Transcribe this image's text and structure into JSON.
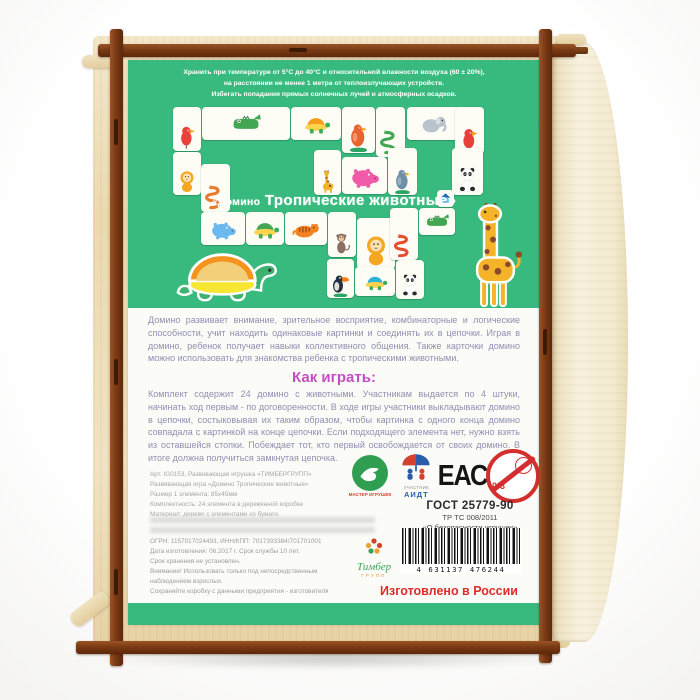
{
  "photo": {
    "description": "wooden box back with game label",
    "colors": {
      "label_green": "#38ba7e",
      "frame_brown": "#7b3a14",
      "plywood": "#ecd9ae",
      "heading_magenta": "#c44ec4",
      "body_text": "#8f8fb2",
      "made_in_red": "#e02b2b"
    }
  },
  "label": {
    "storage_note_lines": [
      "Хранить при температуре от 5°С до 40°С и относительной влажности воздуха (60 ± 20%),",
      "на расстоянии не менее 1 метра от теплоизлучающих устройств.",
      "Избегать попадания прямых солнечных лучей и атмосферных осадков."
    ],
    "title": {
      "prefix": "«Домино",
      "main": "Тропические животные»"
    },
    "chain_tiles": [
      {
        "kind": "parrot",
        "x": 45,
        "y": 47,
        "w": 28,
        "h": 44,
        "c": "#e8413c"
      },
      {
        "kind": "crocodile",
        "x": 74,
        "y": 47,
        "w": 88,
        "h": 33,
        "c": "#43a653"
      },
      {
        "kind": "turtle",
        "x": 163,
        "y": 47,
        "w": 50,
        "h": 33,
        "c": "#f49d1d"
      },
      {
        "kind": "bird",
        "x": 214,
        "y": 47,
        "w": 33,
        "h": 46,
        "c": "#e8632f",
        "mound": true
      },
      {
        "kind": "snake",
        "x": 248,
        "y": 47,
        "w": 29,
        "h": 50,
        "c": "#43a653"
      },
      {
        "kind": "elephant",
        "x": 279,
        "y": 47,
        "w": 53,
        "h": 33,
        "c": "#b9c3cb"
      },
      {
        "kind": "parrot",
        "x": 327,
        "y": 47,
        "w": 29,
        "h": 47,
        "c": "#e8413c"
      },
      {
        "kind": "lion",
        "x": 45,
        "y": 92,
        "w": 28,
        "h": 43,
        "c": "#f5a623"
      },
      {
        "kind": "snake",
        "x": 73,
        "y": 104,
        "w": 29,
        "h": 48,
        "c": "#e87a2e"
      },
      {
        "kind": "giraffe",
        "x": 186,
        "y": 90,
        "w": 27,
        "h": 45,
        "c": "#f0b429"
      },
      {
        "kind": "hippo",
        "x": 214,
        "y": 97,
        "w": 45,
        "h": 37,
        "c": "#ef5ba8"
      },
      {
        "kind": "bird",
        "x": 260,
        "y": 88,
        "w": 29,
        "h": 47,
        "c": "#6f8fa8",
        "mound": true
      },
      {
        "kind": "panda",
        "x": 324,
        "y": 88,
        "w": 31,
        "h": 47,
        "c": "#ffffff"
      },
      {
        "kind": "hippo",
        "x": 73,
        "y": 152,
        "w": 44,
        "h": 33,
        "c": "#6cb9f0"
      },
      {
        "kind": "turtle",
        "x": 118,
        "y": 152,
        "w": 38,
        "h": 33,
        "c": "#43a653"
      },
      {
        "kind": "tiger",
        "x": 157,
        "y": 152,
        "w": 42,
        "h": 33,
        "c": "#f58220"
      },
      {
        "kind": "monkey",
        "x": 200,
        "y": 152,
        "w": 28,
        "h": 45,
        "c": "#8d6e63"
      },
      {
        "kind": "lion",
        "x": 229,
        "y": 158,
        "w": 38,
        "h": 51,
        "c": "#f5a623"
      },
      {
        "kind": "snake",
        "x": 262,
        "y": 148,
        "w": 28,
        "h": 52,
        "c": "#e84b2e"
      },
      {
        "kind": "crocodile",
        "x": 291,
        "y": 148,
        "w": 36,
        "h": 27,
        "c": "#43a653"
      },
      {
        "kind": "house",
        "x": 309,
        "y": 130,
        "w": 17,
        "h": 17,
        "c": "#4fc3f7"
      },
      {
        "kind": "toucan",
        "x": 199,
        "y": 199,
        "w": 27,
        "h": 39,
        "c": "#28323c",
        "mound": true
      },
      {
        "kind": "turtle",
        "x": 227,
        "y": 207,
        "w": 40,
        "h": 29,
        "c": "#2ab4d6"
      },
      {
        "kind": "panda",
        "x": 268,
        "y": 200,
        "w": 28,
        "h": 39,
        "c": "#ffffff"
      }
    ],
    "about_text": "Домино развивает внимание, зрительное восприятие, комбинаторные и логические способности, учит находить одинаковые картинки и соединять их в цепочки. Играя в домино, ребенок получает навыки коллективного общения. Также карточки домино можно использовать для знакомства ребенка с тропическими животными.",
    "how_to_play_heading": "Как играть:",
    "how_to_play_text": "Комплект содержит 24 домино с животными. Участникам выдается по 4 штуки, начинать ход первым - по договоренности. В ходе игры участники выкладывают домино в цепочки, состыковывая их таким образом, чтобы картинка с одного конца домино совпадала с картинкой на конце цепочки. Если подходящего элемента нет, нужно взять из оставшейся стопки. Побеждает тот, кто первый освобождается от своих домино. В итоге должна получиться замкнутая цепочка.",
    "product_details_lines": [
      "Арт. IG0153, Развивающая игрушка «ТИМБЕРГРУПП»",
      "Развивающая игра «Домино Тропические животные»",
      "Размер 1 элемента: 85х45мм",
      "Комплектность: 24 элемента в деревянной коробке",
      "Материал: дерево с элементами из бумаги."
    ],
    "legal_lines": [
      "ОГРН: 1157017024493, ИНН/КПП: 7017393384/701701001",
      "Дата изготовления: 06.2017 г.  Срок службы 10 лет.",
      "Срок хранения не установлен.",
      "Внимание! Использовать только под непосредственным",
      "наблюдением взрослых.",
      "Сохраняйте коробку с данными предприятия - изготовителя"
    ],
    "certification": {
      "master_badge": "МАСТЕР ИГРУШЕК",
      "aidt_caption": "УЧАСТНИК",
      "aidt": "АИДТ",
      "eac": "ЕАС",
      "age_limit": "0-3",
      "gost": "ГОСТ 25779-90",
      "tr_ts": "ТР ТС 008/2011",
      "safety": "«О безопасности игрушек»"
    },
    "barcode_digits": "4 631137 476244",
    "brand": {
      "name": "Тимбер",
      "sub": "ГРУПП"
    },
    "made_in": "Изготовлено в России"
  }
}
